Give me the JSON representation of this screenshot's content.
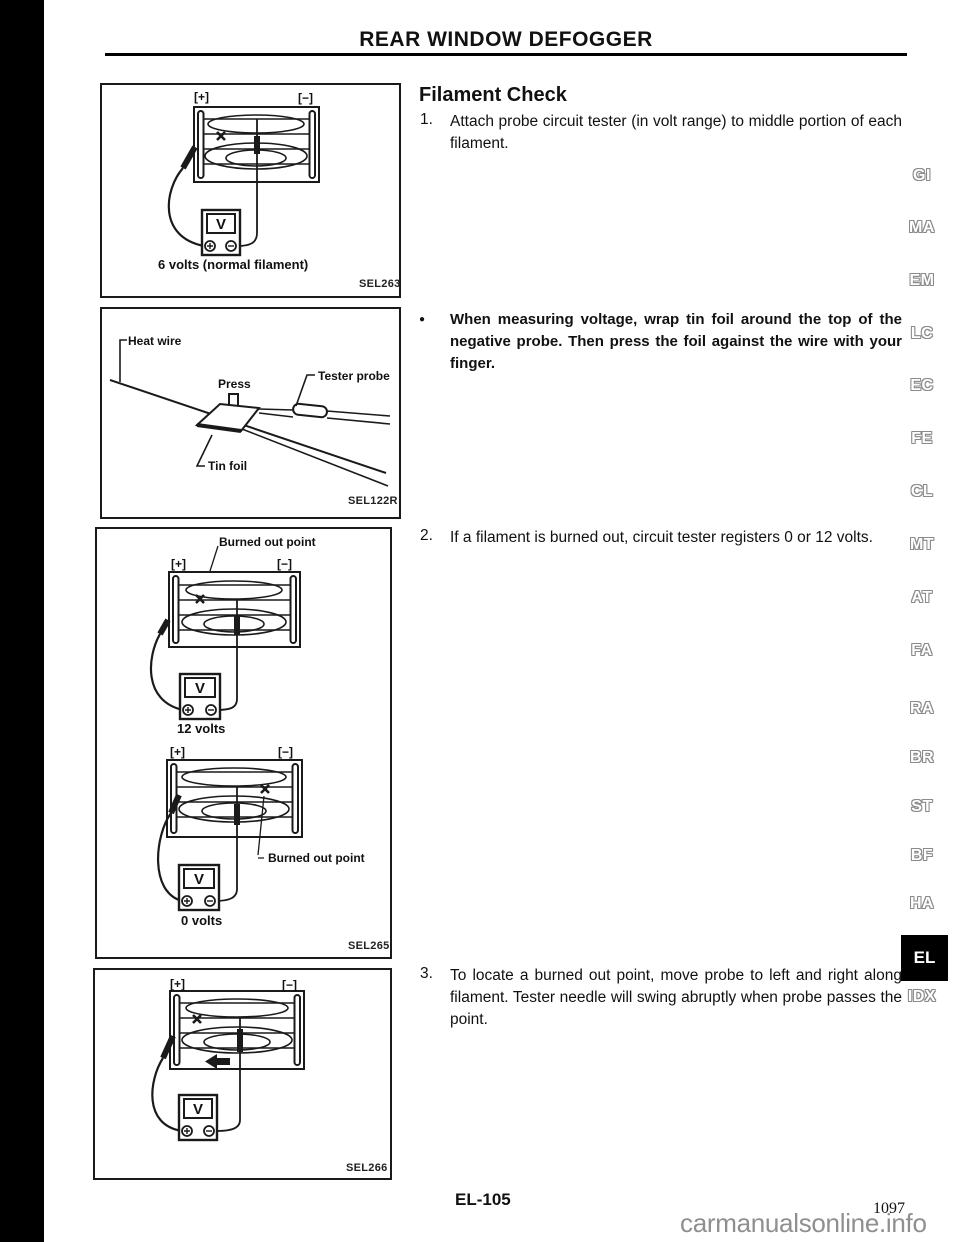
{
  "page": {
    "header": "REAR WINDOW DEFOGGER",
    "footer_code": "EL-105",
    "page_number": "1097",
    "watermark": "carmanualsonline.info"
  },
  "content": {
    "title": "Filament Check",
    "step1_num": "1.",
    "step1_text": "Attach probe circuit tester (in volt range) to middle portion of each filament.",
    "note_bullet": "●",
    "note_text": "When measuring voltage, wrap tin foil around the top of the negative probe. Then press the foil against the wire with your finger.",
    "step2_num": "2.",
    "step2_text": "If a filament is burned out, circuit tester registers 0 or 12 volts.",
    "step3_num": "3.",
    "step3_text": "To locate a burned out point, move probe to left and right along filament. Tester needle will swing abruptly when probe passes the point."
  },
  "fig1": {
    "plus": "[+]",
    "minus": "[−]",
    "meter_v": "V",
    "caption": "6 volts (normal filament)",
    "code": "SEL263"
  },
  "fig2": {
    "heat_wire": "Heat wire",
    "press": "Press",
    "tester_probe": "Tester probe",
    "tin_foil": "Tin foil",
    "code": "SEL122R"
  },
  "fig3": {
    "burned1": "Burned out point",
    "plus1": "[+]",
    "minus1": "[−]",
    "meter_v1": "V",
    "caption1": "12 volts",
    "plus2": "[+]",
    "minus2": "[−]",
    "meter_v2": "V",
    "burned2": "Burned out point",
    "caption2": "0 volts",
    "code": "SEL265"
  },
  "fig4": {
    "plus": "[+]",
    "minus": "[−]",
    "meter_v": "V",
    "code": "SEL266"
  },
  "margin": {
    "tabs": [
      "GI",
      "MA",
      "EM",
      "LC",
      "EC",
      "FE",
      "CL",
      "MT",
      "AT",
      "FA",
      "RA",
      "BR",
      "ST",
      "BF",
      "HA"
    ],
    "active_tab": "EL",
    "index_tab": "IDX"
  }
}
